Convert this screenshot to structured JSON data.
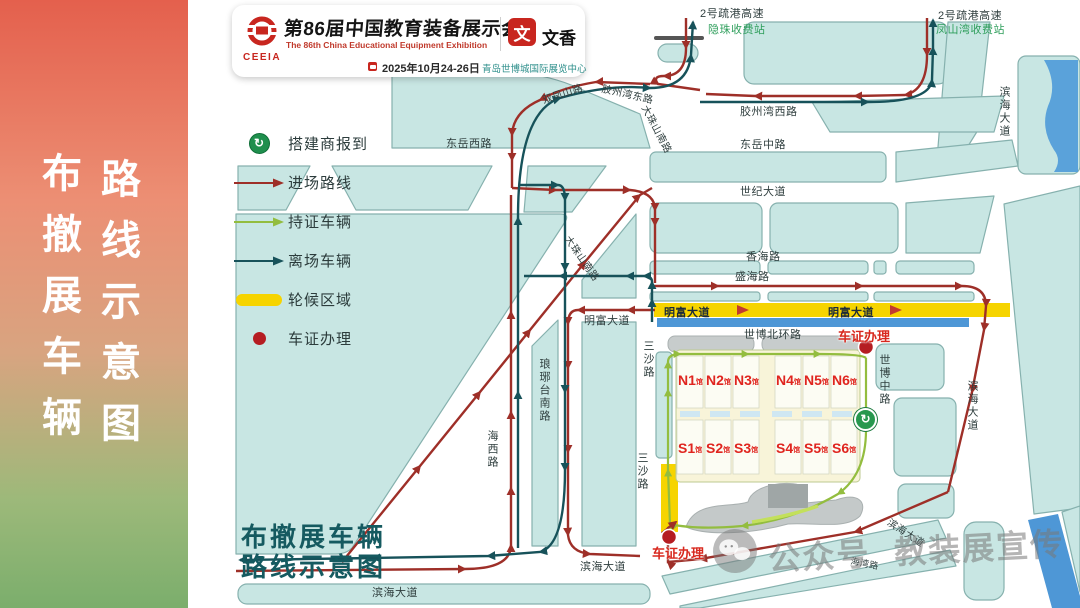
{
  "sidebar": {
    "col1": "布撤展车辆",
    "col2": "路线示意图"
  },
  "header": {
    "logo": "CEEIA",
    "title": "第86届中国教育装备展示会",
    "subtitle": "The 86th China Educational Equipment Exhibition",
    "date": "2025年10月24-26日",
    "venue": "青岛世博城国际展览中心",
    "seal_glyph": "文",
    "seal_name": "文香"
  },
  "legend": {
    "items": [
      {
        "icon": "builder-checkin-icon",
        "label": "搭建商报到"
      },
      {
        "icon": "entry-route-arrow",
        "label": "进场路线"
      },
      {
        "icon": "permit-vehicle-arrow",
        "label": "持证车辆"
      },
      {
        "icon": "exit-vehicle-arrow",
        "label": "离场车辆"
      },
      {
        "icon": "waiting-zone-swatch",
        "label": "轮候区域"
      },
      {
        "icon": "vehicle-pass-dot",
        "label": "车证办理"
      }
    ]
  },
  "map": {
    "labels": {
      "hw2": "2号疏港高速",
      "toll_nw": "隐珠收费站",
      "toll_ne": "凤山湾收费站",
      "binhai": "滨海大道",
      "jiaozhou_w": "胶州湾西路",
      "jiaozhou_e": "胶州湾东路",
      "shuangfeng": "双凤山路",
      "dazhushan": "大珠山南路",
      "dongyue_w": "东岳西路",
      "dongyue_m": "东岳中路",
      "shiji": "世纪大道",
      "xianghai": "香海路",
      "shenghai": "盛海路",
      "mingfu": "明富大道",
      "sansha": "三沙路",
      "shibo_n": "世博北环路",
      "shibo_m": "世博中路",
      "haixi": "海西路",
      "langya": "琅琊台南路",
      "haiwan": "海湾路",
      "chezheng": "车证办理"
    },
    "halls": {
      "suffix": "馆",
      "north": [
        "N1",
        "N2",
        "N3",
        "N4",
        "N5",
        "N6"
      ],
      "south": [
        "S1",
        "S2",
        "S3",
        "S4",
        "S5",
        "S6"
      ]
    }
  },
  "icons": {
    "checkin_glyph": "↻"
  },
  "footer": {
    "line1": "布撤展车辆",
    "line2": "路线示意图"
  },
  "watermark": {
    "account": "公众号",
    "name": "教装展宣传"
  },
  "colors": {
    "entry_route": "#9e2f28",
    "permit_route": "#93bd3f",
    "exit_route": "#17525a",
    "waiting_zone": "#f6d400",
    "pass_point": "#b51d22",
    "city_block": "#c8e6e3",
    "water": "#4e97d6",
    "sidebar_top": "#e4604d",
    "sidebar_bottom": "#7bae6c"
  }
}
